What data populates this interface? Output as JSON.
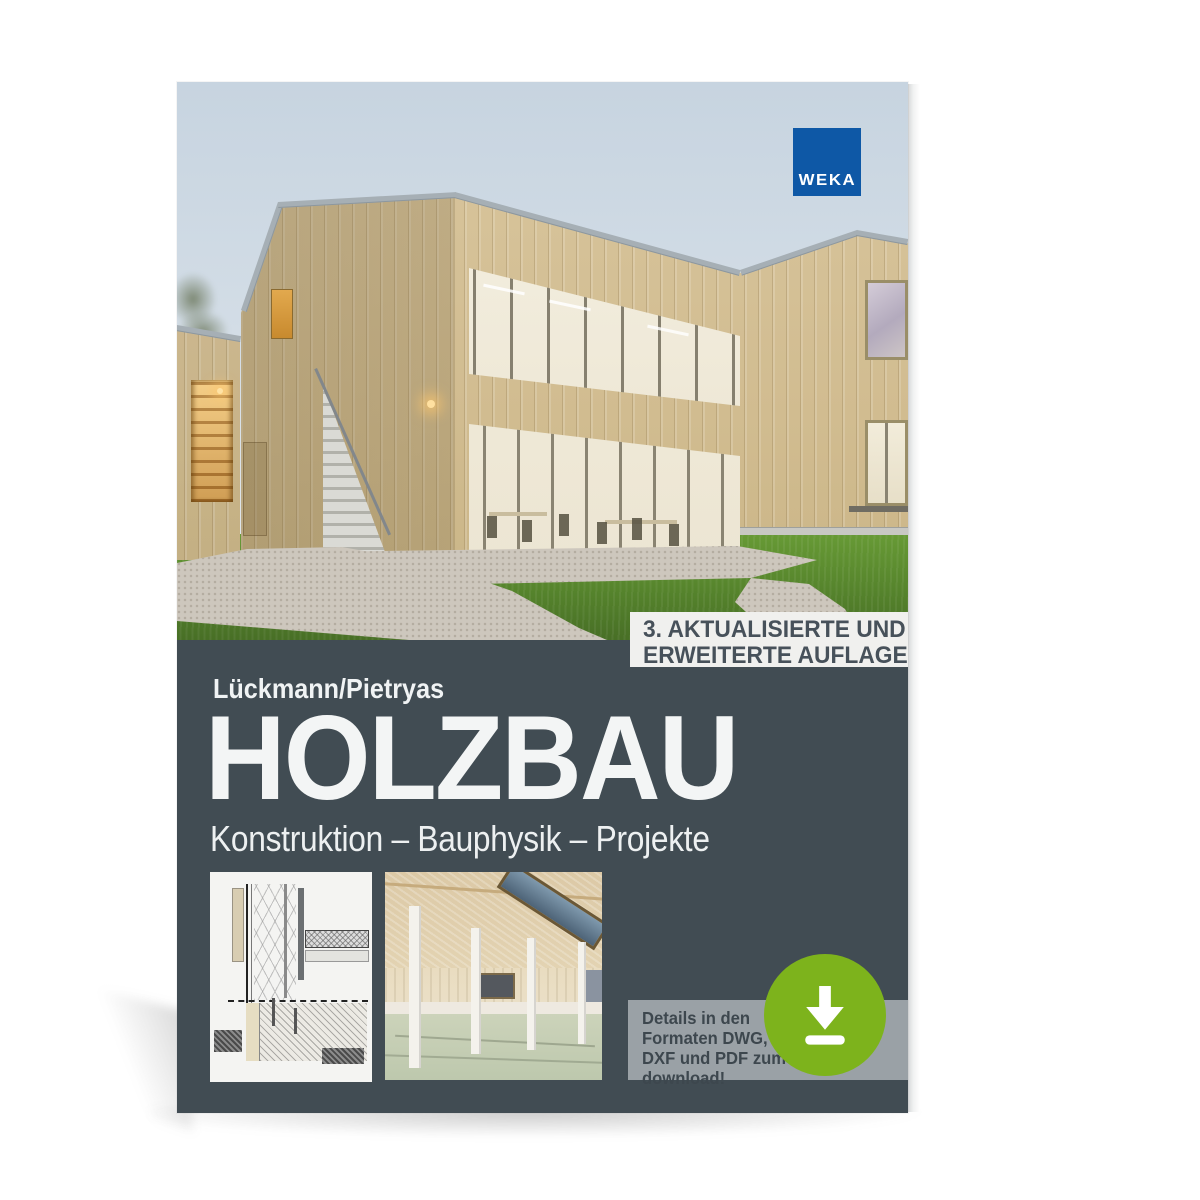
{
  "cover": {
    "publisher": {
      "logo_text": "WEKA",
      "brand_blue": "#0e58a6"
    },
    "edition_badge": {
      "lines": [
        "3. AKTUALISIERTE UND",
        "ERWEITERTE AUFLAGE"
      ]
    },
    "author": "Lückmann/Pietryas",
    "title": "HOLZBAU",
    "subtitle": "Konstruktion – Bauphysik – Projekte",
    "download_note": {
      "lines": [
        "Details in den",
        "Formaten DWG,",
        "DXF und PDF zum",
        "download!"
      ]
    },
    "icons": {
      "download": "download-arrow-icon"
    },
    "colors": {
      "panel": "#414c53",
      "accent_green": "#7db31c",
      "badge_bg": "#f0f0ee",
      "photo_sky": "#cdd9e3"
    }
  }
}
